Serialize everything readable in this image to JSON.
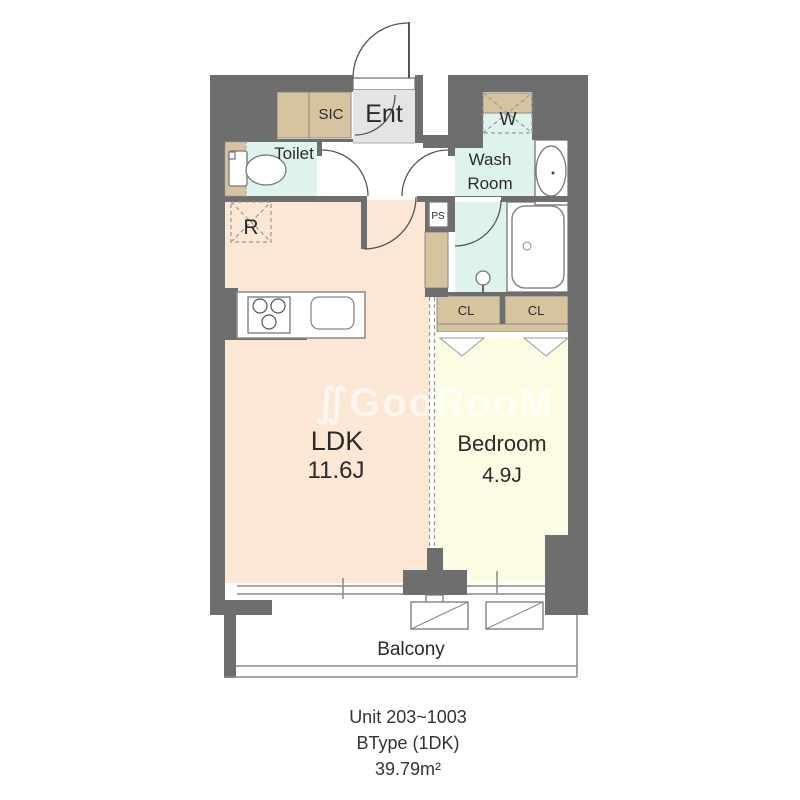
{
  "watermark": "∬GooRooM",
  "rooms": {
    "ent": "Ent",
    "sic": "SIC",
    "washer": "W",
    "toilet": "Toilet",
    "wash_room_line1": "Wash",
    "wash_room_line2": "Room",
    "ps": "PS",
    "fridge": "R",
    "cl_left": "CL",
    "cl_right": "CL",
    "ldk": "LDK",
    "ldk_size": "11.6J",
    "bedroom": "Bedroom",
    "bedroom_size": "4.9J",
    "balcony": "Balcony"
  },
  "footer": {
    "unit": "Unit 203~1003",
    "type": "BType (1DK)",
    "area": "39.79m²"
  },
  "colors": {
    "wall": "#6e6e6e",
    "ldk_floor": "#fbe7d4",
    "bedroom_floor": "#fcfce3",
    "wet_area": "#dff3ed",
    "closet": "#d7c39e",
    "entrance": "#e4e4e3"
  }
}
